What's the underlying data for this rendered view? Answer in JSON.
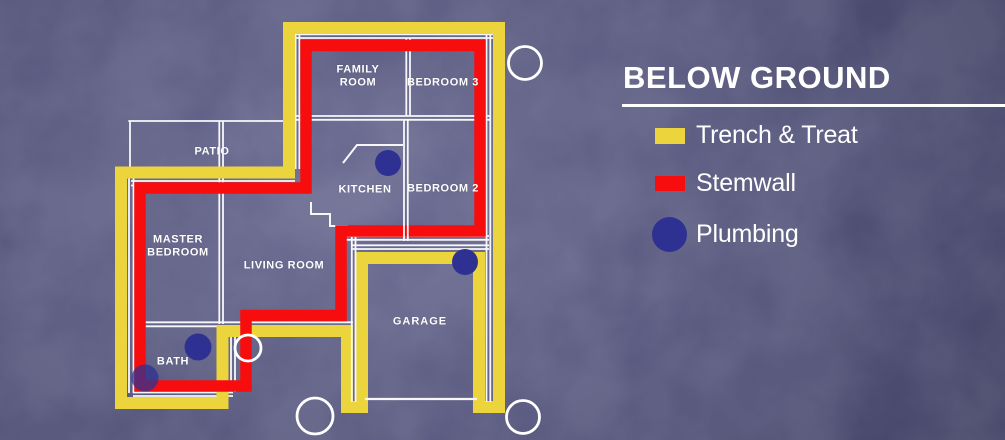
{
  "title": {
    "text": "BELOW GROUND"
  },
  "legend": {
    "items": [
      {
        "label": "Trench & Treat",
        "swatch": "rect",
        "color_key": "trench"
      },
      {
        "label": "Stemwall",
        "swatch": "rect",
        "color_key": "stemwall"
      },
      {
        "label": "Plumbing",
        "swatch": "circle",
        "color_key": "plumbing"
      }
    ]
  },
  "plan": {
    "rooms": [
      {
        "name": "FAMILY ROOM"
      },
      {
        "name": "BEDROOM 3"
      },
      {
        "name": "PATIO"
      },
      {
        "name": "KITCHEN"
      },
      {
        "name": "BEDROOM 2"
      },
      {
        "name": "MASTER BEDROOM"
      },
      {
        "name": "LIVING ROOM"
      },
      {
        "name": "GARAGE"
      },
      {
        "name": "BATH"
      }
    ],
    "plumbing_points": [
      {
        "x": 388,
        "y": 163,
        "r": 13,
        "opacity": 1
      },
      {
        "x": 465,
        "y": 262,
        "r": 13,
        "opacity": 1
      },
      {
        "x": 198,
        "y": 347,
        "r": 13.5,
        "opacity": 1
      },
      {
        "x": 145,
        "y": 378,
        "r": 13.5,
        "opacity": 0.75
      }
    ],
    "outline_markers": [
      {
        "x": 525,
        "y": 63,
        "r": 16.5
      },
      {
        "x": 248,
        "y": 348,
        "r": 13
      },
      {
        "x": 315,
        "y": 416,
        "r": 18
      },
      {
        "x": 523,
        "y": 417,
        "r": 16.5
      }
    ]
  },
  "colors": {
    "background": "#4B4B75",
    "trench": "#EBD43C",
    "stemwall": "#F70D0D",
    "plumbing": "#2E3192",
    "wall": "#F7F7FA",
    "text": "#FFFFFF"
  }
}
